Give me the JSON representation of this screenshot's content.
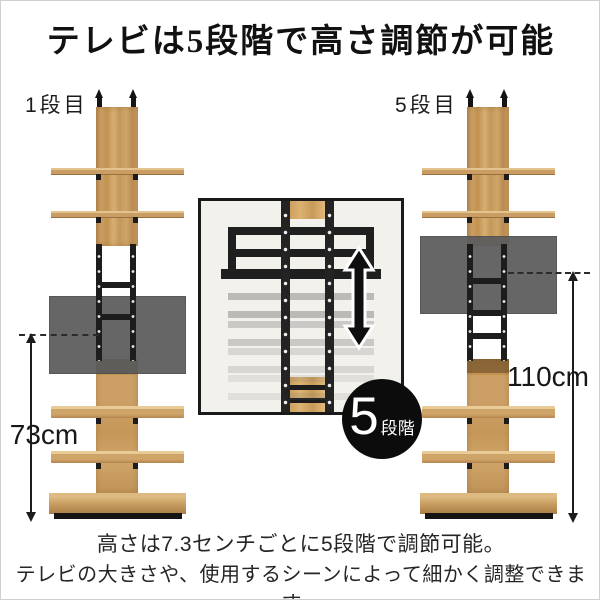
{
  "title": "テレビは5段階で高さ調節が可能",
  "towers": {
    "left": {
      "label": "1段目",
      "height": "73cm"
    },
    "right": {
      "label": "5段目",
      "height": "110cm"
    }
  },
  "badge": {
    "number": "5",
    "suffix": "段階"
  },
  "caption": {
    "line1": "高さは7.3センチごとに5段階で調節可能。",
    "line2": "テレビの大きさや、使用するシーンによって細かく調整できます。"
  },
  "icons": {
    "up_down_arrow": "height-adjust-arrow",
    "ceiling_rod": "tension-rod"
  },
  "colors": {
    "wood": "#c89a5f",
    "metal": "#1c1c1c",
    "tv_gray": "#5d5d5d",
    "badge_bg": "#0c0c0c",
    "inset_bg": "#f3f1ec",
    "text": "#1a1a1a"
  }
}
